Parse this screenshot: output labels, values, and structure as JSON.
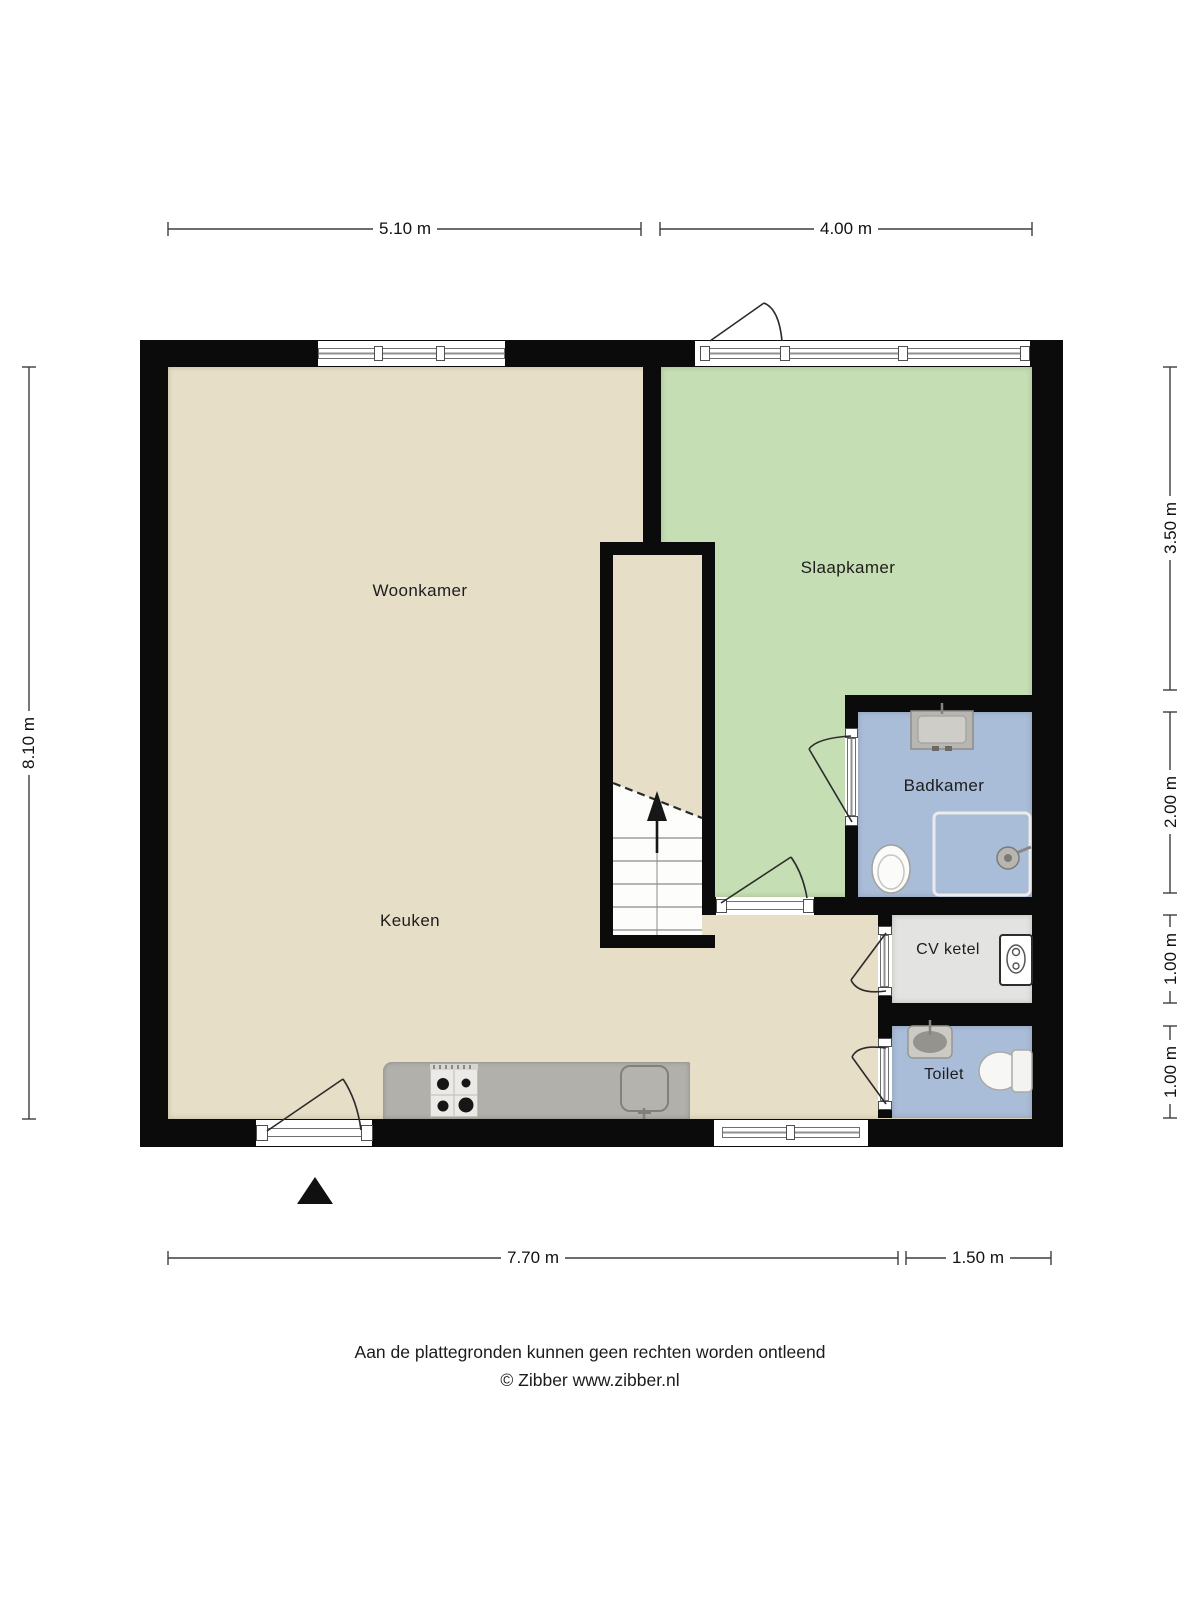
{
  "rooms": {
    "woonkamer": {
      "label": "Woonkamer"
    },
    "slaapkamer": {
      "label": "Slaapkamer"
    },
    "badkamer": {
      "label": "Badkamer"
    },
    "keuken": {
      "label": "Keuken"
    },
    "cv_ketel": {
      "label": "CV ketel"
    },
    "toilet": {
      "label": "Toilet"
    }
  },
  "dimensions": {
    "top": [
      "5.10 m",
      "4.00 m"
    ],
    "left": [
      "8.10 m"
    ],
    "right": [
      "3.50 m",
      "2.00 m",
      "1.00 m",
      "1.00 m"
    ],
    "bottom": [
      "7.70 m",
      "1.50 m"
    ]
  },
  "footer": {
    "disclaimer": "Aan de plattegronden kunnen geen rechten worden ontleend",
    "copyright": "© Zibber www.zibber.nl"
  },
  "fixtures": {
    "badkamer": [
      "sink",
      "toilet",
      "shower"
    ],
    "toilet_room": [
      "sink",
      "toilet"
    ],
    "cv_ketel": [
      "boiler"
    ],
    "keuken": [
      "counter",
      "stove",
      "sink"
    ],
    "stairwell": "staircase-up",
    "compass": "north-arrow"
  },
  "colors": {
    "wall": "#0b0b0b",
    "floor_main": "#e7dec7",
    "floor_bedroom": "#c5deb3",
    "floor_bath": "#a9bcd8",
    "floor_boiler": "#e3e3e1",
    "floor_toilet": "#a9bcd8",
    "counter": "#b2b0ab"
  }
}
